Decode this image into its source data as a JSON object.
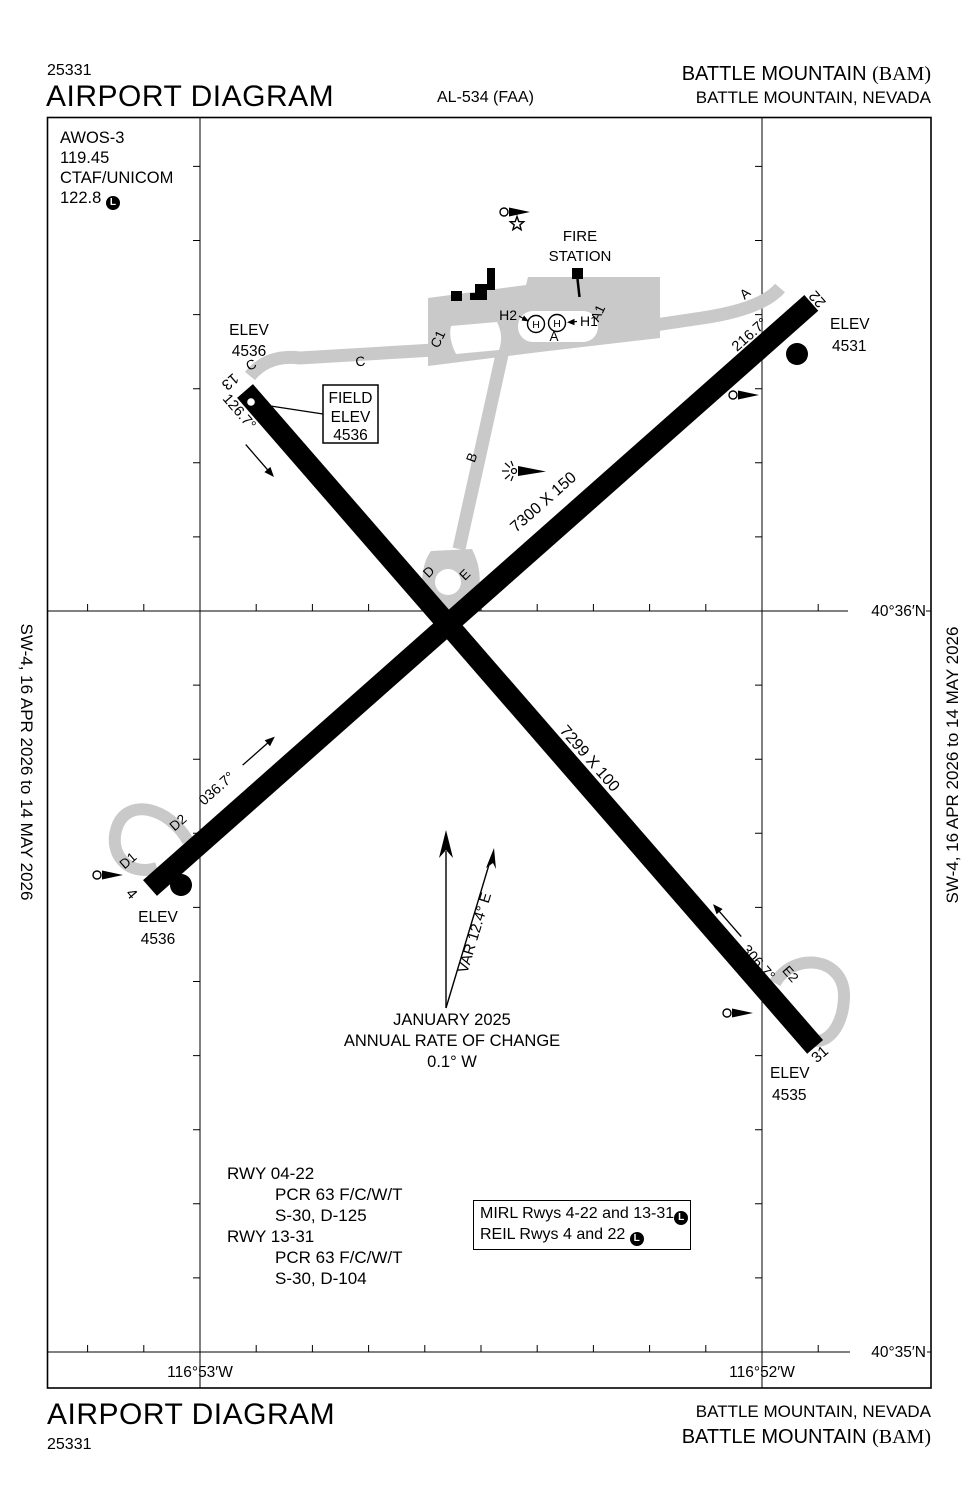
{
  "page": {
    "pub_number": "25331",
    "title": "AIRPORT DIAGRAM",
    "procedure_ref": "AL-534 (FAA)",
    "airport_name": "BATTLE MOUNTAIN ",
    "airport_id": "(BAM)",
    "city": "BATTLE MOUNTAIN, NEVADA",
    "edition_left": "SW-4,  16 APR 2026  to  14 MAY 2026",
    "edition_right": "SW-4,  16 APR 2026  to  14 MAY 2026"
  },
  "comm": {
    "l1": "AWOS-3",
    "l2": "119.45",
    "l3": "CTAF/UNICOM",
    "l4": "122.8",
    "lighted": "L"
  },
  "field_elev": {
    "l1": "FIELD",
    "l2": "ELEV",
    "l3": "4536"
  },
  "fire_station": {
    "l1": "FIRE",
    "l2": "STATION"
  },
  "north_arrow": {
    "var": "VAR 12.4°  E",
    "date": "JANUARY 2025",
    "rate_label": "ANNUAL RATE OF CHANGE",
    "rate_value": "0.1° W"
  },
  "runway_13_31": {
    "dimensions": "7299 X 100",
    "rwy13": {
      "number": "13",
      "heading": "126.7°",
      "elev_label": "ELEV",
      "elev_value": "4536"
    },
    "rwy31": {
      "number": "31",
      "heading": "306.7°",
      "elev_label": "ELEV",
      "elev_value": "4535"
    }
  },
  "runway_04_22": {
    "dimensions": "7300 X 150",
    "rwy4": {
      "number": "4",
      "heading": "036.7°",
      "elev_label": "ELEV",
      "elev_value": "4536"
    },
    "rwy22": {
      "number": "22",
      "heading": "216.7°",
      "elev_label": "ELEV",
      "elev_value": "4531"
    }
  },
  "taxiways": {
    "a": "A",
    "a_east": "A",
    "a1": "A1",
    "b": "B",
    "c": "C",
    "c_west": "C",
    "c1": "C1",
    "d": "D",
    "d1": "D1",
    "d2": "D2",
    "e": "E",
    "e1": "E1",
    "e2": "E2"
  },
  "helipads": {
    "h1": "H1",
    "h2": "H2",
    "h": "H"
  },
  "symbols": {
    "parking": "P",
    "lighted": "L"
  },
  "runway_data": {
    "r1": "RWY 04-22",
    "r1a": "PCR 63 F/C/W/T",
    "r1b": "S-30, D-125",
    "r2": "RWY 13-31",
    "r2a": "PCR 63 F/C/W/T",
    "r2b": "S-30, D-104"
  },
  "lighting_box": {
    "l1": "MIRL Rwys 4-22 and 13-31",
    "l2": "REIL Rwys 4 and 22 ",
    "lighted": "L"
  },
  "coordinates": {
    "lat_top": "40°36′N",
    "lat_bottom": "40°35′N",
    "lon_left": "116°53′W",
    "lon_right": "116°52′W"
  }
}
